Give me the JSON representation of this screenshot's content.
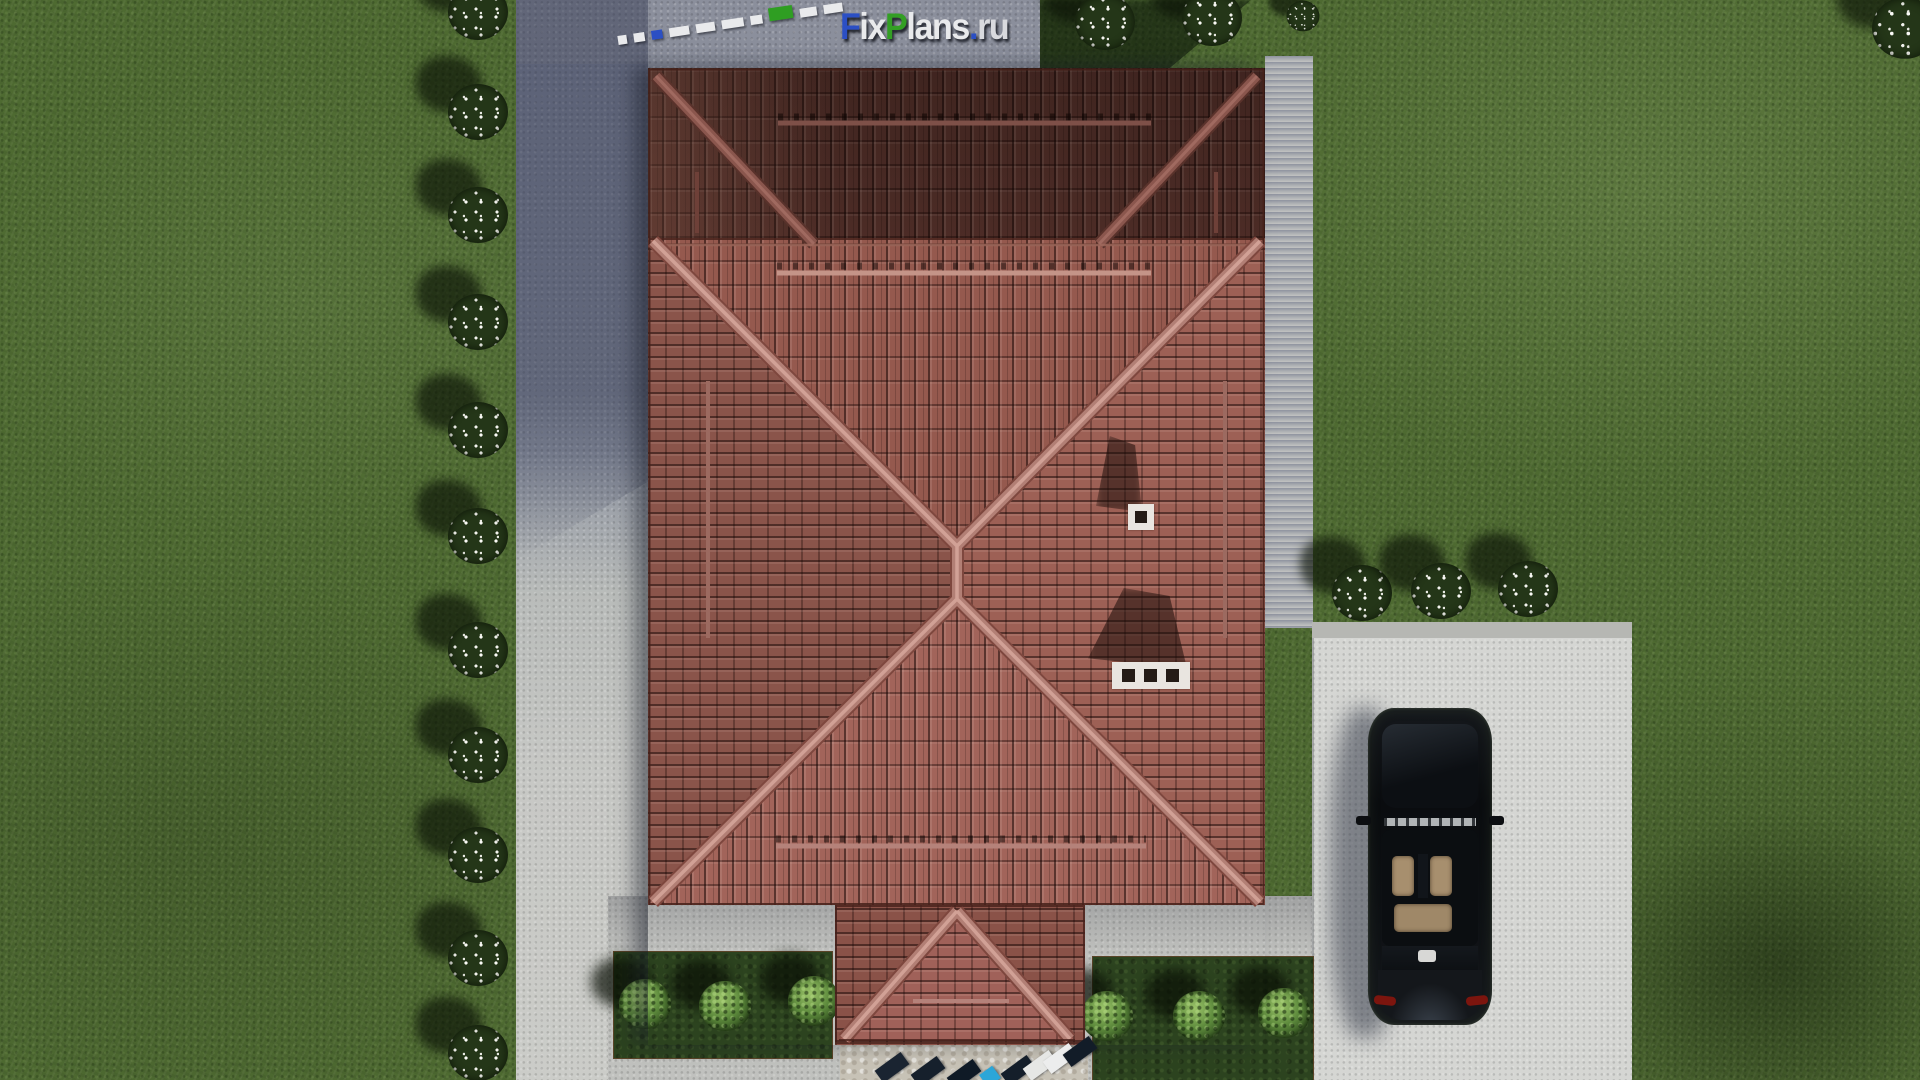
{
  "watermark": {
    "full_text": "FixPlans.ru",
    "segments": {
      "f": "F",
      "ix": "ix",
      "p": "P",
      "lans": "lans",
      "dot": ".",
      "ru": "ru"
    },
    "colors": {
      "blue": "#2b4fc4",
      "green": "#339f24",
      "white": "#e9eaec"
    },
    "scalebar_segment_colors": [
      "white",
      "white",
      "blue",
      "white",
      "white",
      "white",
      "white",
      "green",
      "white",
      "white"
    ]
  },
  "palette": {
    "roof_tile_lit": "#9d6156",
    "roof_tile_shadowed": "#5e362f",
    "roof_ridge": "#b27f75",
    "grass": "#4e6a31",
    "grass_shadow": "#1f2f17",
    "driveway_shadowed": "#8b8f9c",
    "path_concrete": "#c7c8c5",
    "parking_pad": "#d5d6d3",
    "patio_stone": "#c7c2b6",
    "car_body": "#0b0d10",
    "car_seats": "#a78f6e",
    "taillight": "#7c150e",
    "flower_bush_white": "#f2f2ee",
    "green_bush": "#6f9c4a"
  },
  "scene_objects": [
    "hip-roof-house",
    "garage-roof-section",
    "entry-porch-roof",
    "chimney-small",
    "chimney-large",
    "black-sedan-top-view",
    "parking-pad",
    "driveway",
    "garden-path",
    "lawn",
    "white-flower-bushes",
    "green-bushes",
    "entry-steps",
    "stone-patio"
  ]
}
